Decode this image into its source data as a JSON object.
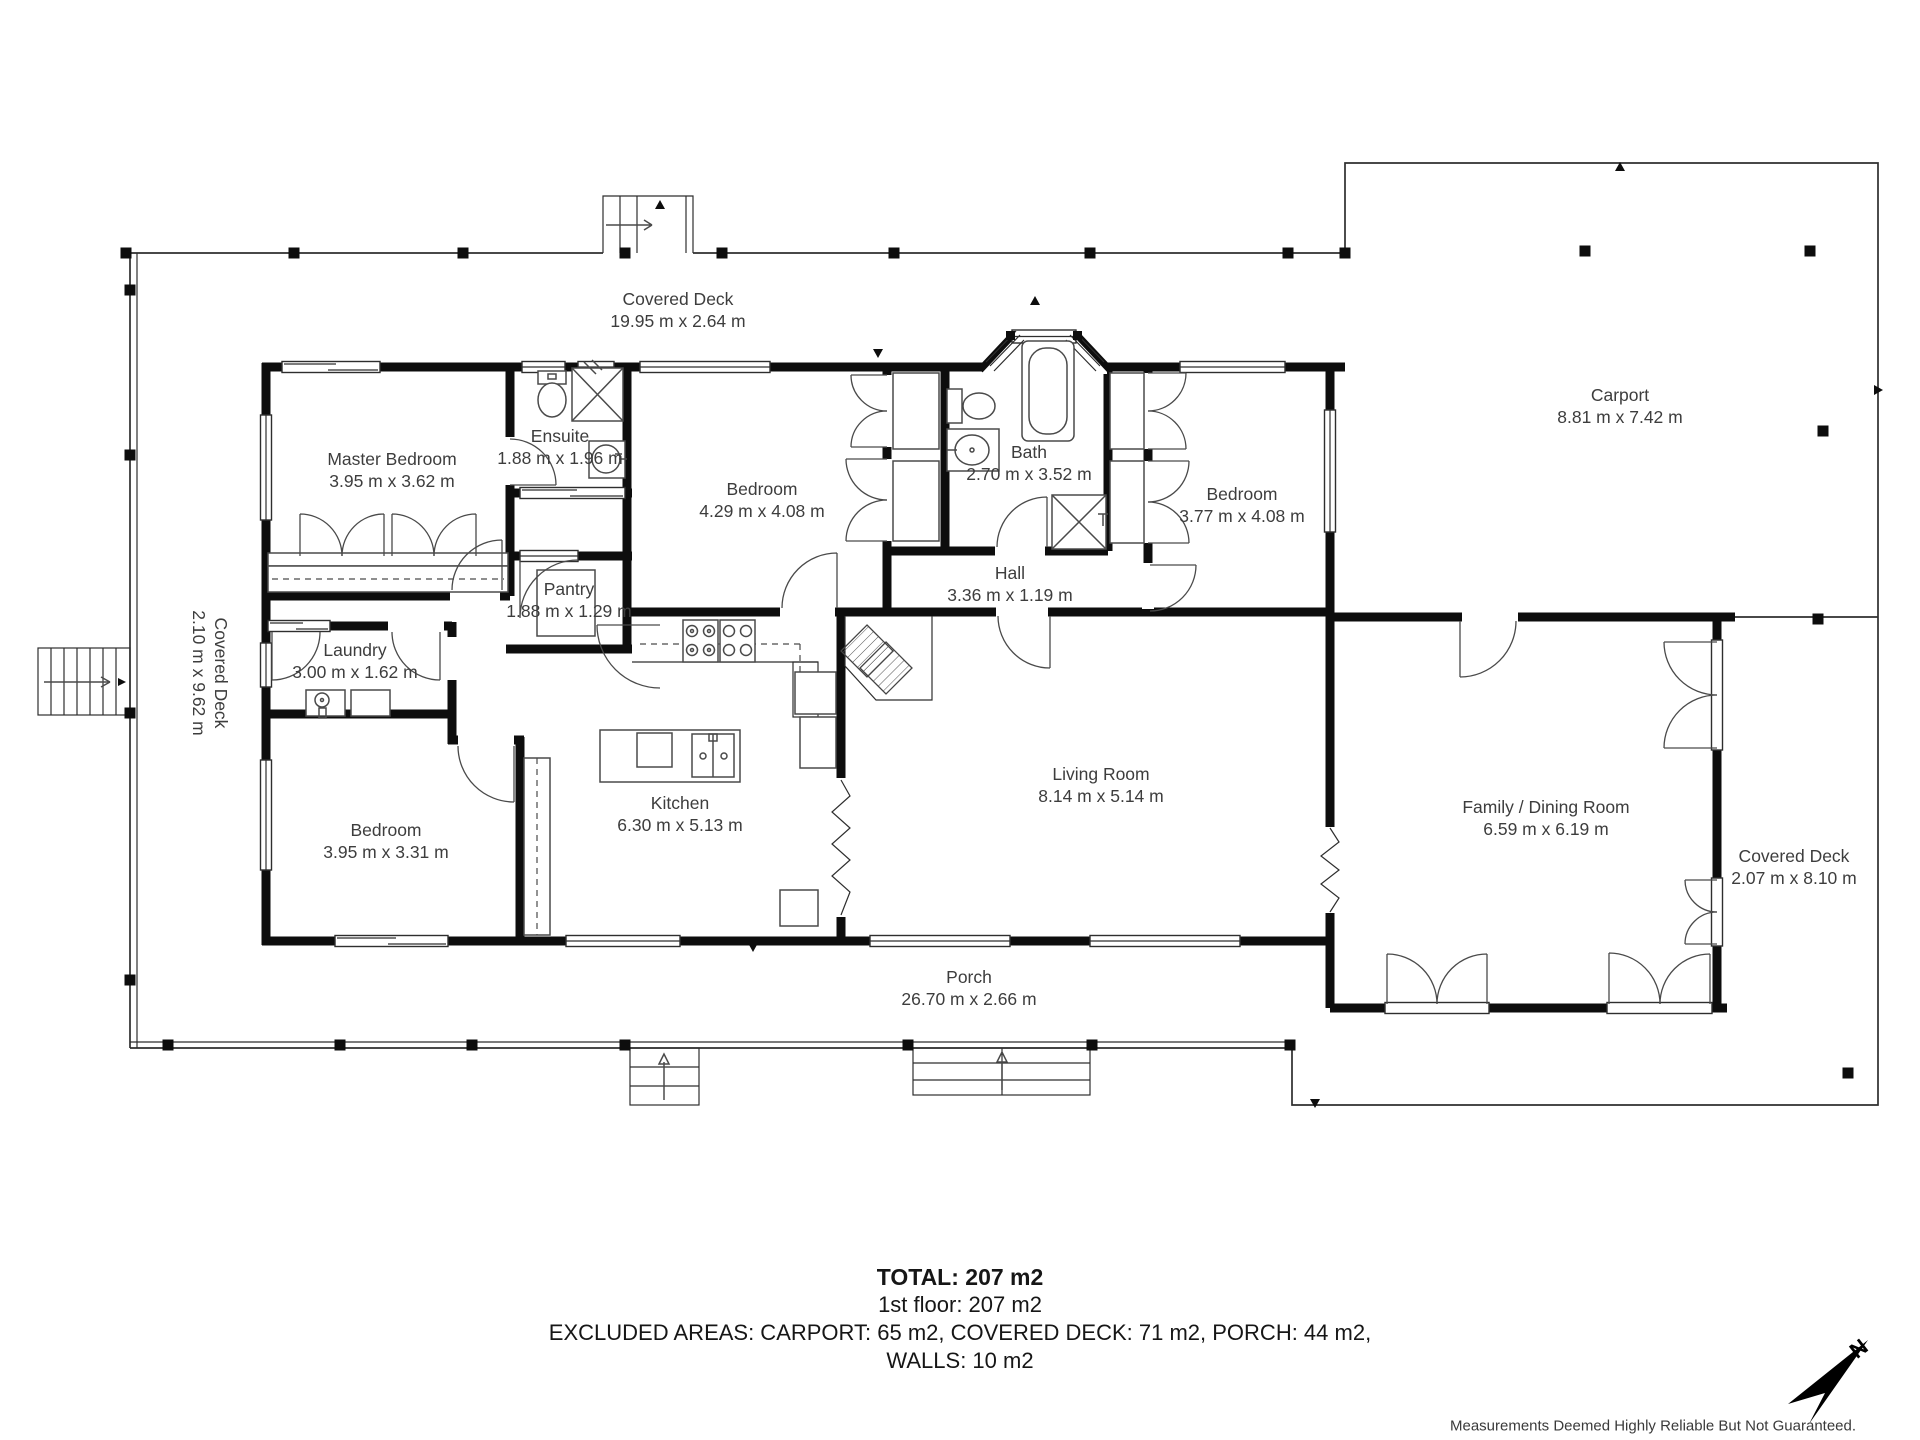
{
  "rooms": [
    {
      "id": "covered-deck-top",
      "name": "Covered Deck",
      "dims": "19.95 m x 2.64 m",
      "x": 678,
      "y": 310,
      "rotated": false
    },
    {
      "id": "carport",
      "name": "Carport",
      "dims": "8.81 m x 7.42 m",
      "x": 1620,
      "y": 406,
      "rotated": false
    },
    {
      "id": "master-bedroom",
      "name": "Master Bedroom",
      "dims": "3.95 m x 3.62 m",
      "x": 392,
      "y": 470,
      "rotated": false
    },
    {
      "id": "ensuite",
      "name": "Ensuite",
      "dims": "1.88 m x 1.96 m",
      "x": 560,
      "y": 447,
      "rotated": false
    },
    {
      "id": "bedroom-middle",
      "name": "Bedroom",
      "dims": "4.29 m x 4.08 m",
      "x": 762,
      "y": 500,
      "rotated": false
    },
    {
      "id": "bath",
      "name": "Bath",
      "dims": "2.70 m x 3.52 m",
      "x": 1029,
      "y": 463,
      "rotated": false
    },
    {
      "id": "bedroom-right",
      "name": "Bedroom",
      "dims": "3.77 m x 4.08 m",
      "x": 1242,
      "y": 505,
      "rotated": false
    },
    {
      "id": "hall",
      "name": "Hall",
      "dims": "3.36 m x 1.19 m",
      "x": 1010,
      "y": 584,
      "rotated": false
    },
    {
      "id": "pantry",
      "name": "Pantry",
      "dims": "1.88 m x 1.29 m",
      "x": 569,
      "y": 600,
      "rotated": false
    },
    {
      "id": "laundry",
      "name": "Laundry",
      "dims": "3.00 m x 1.62 m",
      "x": 355,
      "y": 661,
      "rotated": false
    },
    {
      "id": "covered-deck-left",
      "name": "Covered Deck",
      "dims": "2.10 m x 9.62 m",
      "x": 210,
      "y": 673,
      "rotated": true
    },
    {
      "id": "bedroom-left",
      "name": "Bedroom",
      "dims": "3.95 m x 3.31 m",
      "x": 386,
      "y": 841,
      "rotated": false
    },
    {
      "id": "kitchen",
      "name": "Kitchen",
      "dims": "6.30 m x 5.13 m",
      "x": 680,
      "y": 814,
      "rotated": false
    },
    {
      "id": "living-room",
      "name": "Living Room",
      "dims": "8.14 m x 5.14 m",
      "x": 1101,
      "y": 785,
      "rotated": false
    },
    {
      "id": "family-dining-room",
      "name": "Family / Dining Room",
      "dims": "6.59 m x 6.19 m",
      "x": 1546,
      "y": 818,
      "rotated": false
    },
    {
      "id": "covered-deck-right",
      "name": "Covered Deck",
      "dims": "2.07 m x 8.10 m",
      "x": 1794,
      "y": 867,
      "rotated": false
    },
    {
      "id": "porch",
      "name": "Porch",
      "dims": "26.70 m x 2.66 m",
      "x": 969,
      "y": 988,
      "rotated": false
    }
  ],
  "summary": {
    "total": "TOTAL: 207 m2",
    "floor": "1st floor: 207 m2",
    "excluded": "EXCLUDED AREAS: CARPORT: 65 m2, COVERED DECK: 71 m2, PORCH: 44 m2,",
    "walls": "WALLS: 10 m2"
  },
  "disclaimer": "Measurements Deemed Highly Reliable But Not Guaranteed.",
  "compass": {
    "north_label": "N"
  },
  "colors": {
    "wall": "#0d0d0d",
    "line": "#2e2e2e",
    "fixture": "#4a4a4a",
    "text": "#3d3d3d",
    "background": "#ffffff"
  }
}
